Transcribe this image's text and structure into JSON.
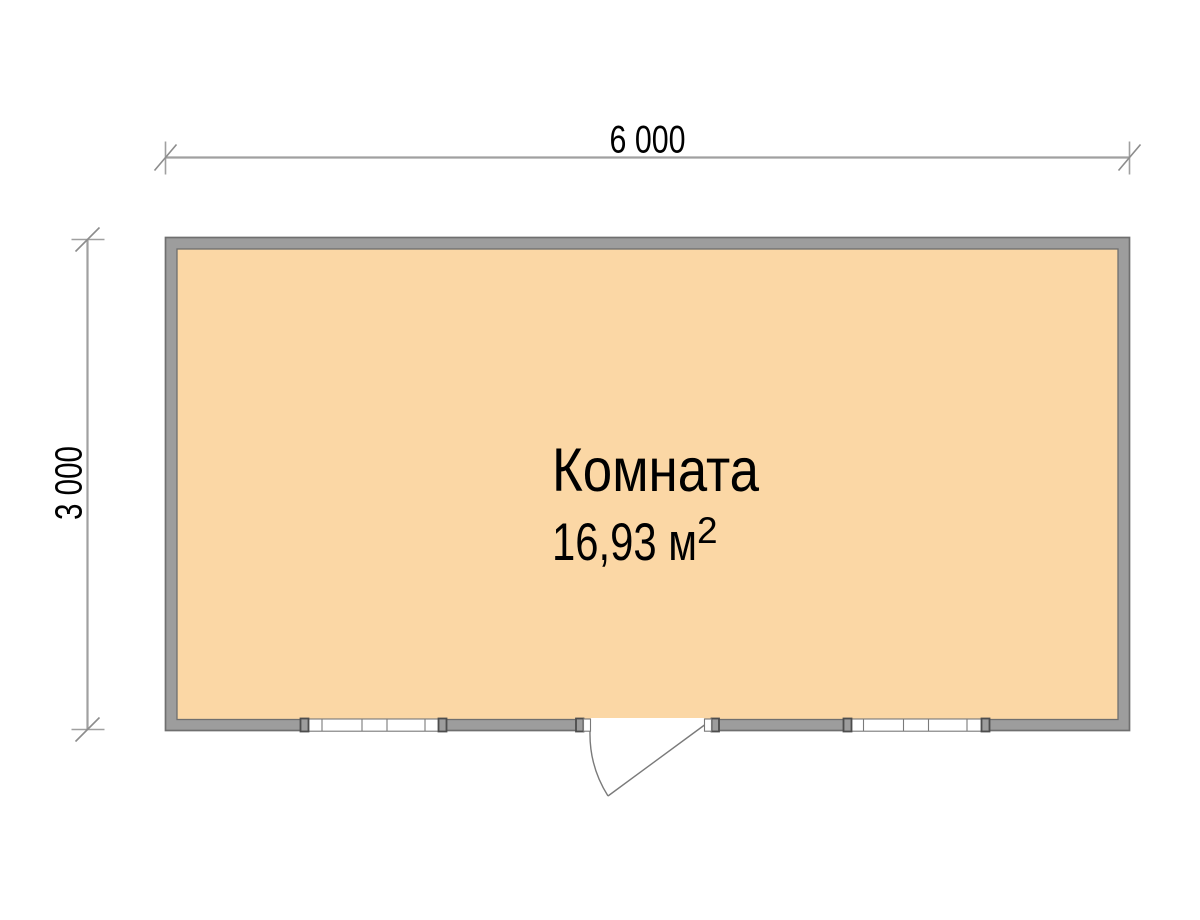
{
  "plan": {
    "room": {
      "name": "Комната",
      "area_value": "16,93 м",
      "area_superscript": "2"
    },
    "dimensions": {
      "width_label": "6 000",
      "height_label": "3 000"
    }
  },
  "colors": {
    "background": "#FFFFFF",
    "floor": "#FBD7A5",
    "wall_fill": "#9D9D9D",
    "wall_outline": "#6F6F6F",
    "window_frame": "#787878",
    "dimension_line": "#A0A0A0",
    "text": "#000000"
  }
}
